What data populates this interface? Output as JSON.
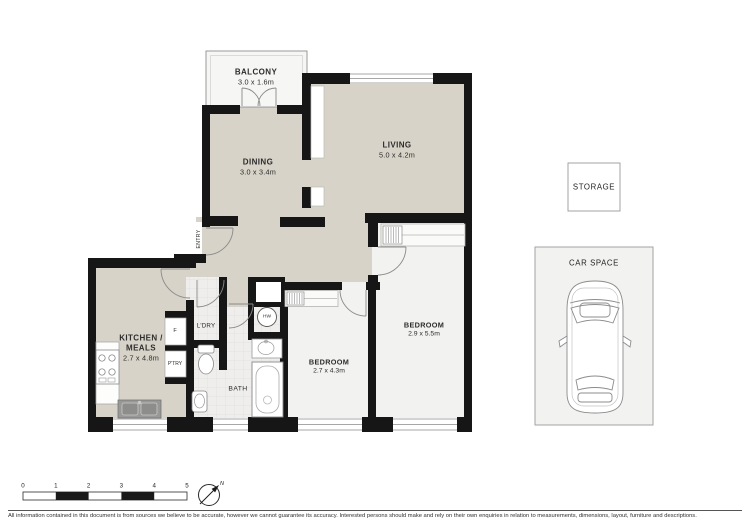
{
  "rooms": {
    "balcony": {
      "label": "BALCONY",
      "dims": "3.0 x 1.6m"
    },
    "dining": {
      "label": "DINING",
      "dims": "3.0 x 3.4m"
    },
    "living": {
      "label": "LIVING",
      "dims": "5.0 x 4.2m"
    },
    "kitchen": {
      "label_line1": "KITCHEN /",
      "label_line2": "MEALS",
      "dims": "2.7 x 4.8m"
    },
    "bedroom1": {
      "label": "BEDROOM",
      "dims": "2.7 x 4.3m"
    },
    "bedroom2": {
      "label": "BEDROOM",
      "dims": "2.9 x 5.5m"
    },
    "bath": {
      "label": "BATH"
    },
    "laundry": {
      "label": "L'DRY"
    },
    "pantry": {
      "label": "P'TRY"
    },
    "fridge": {
      "label": "F"
    },
    "hot_water": {
      "label": "HW"
    },
    "entry": {
      "label": "ENTRY"
    },
    "storage": {
      "label": "STORAGE"
    },
    "car_space": {
      "label": "CAR SPACE"
    }
  },
  "scale_bar": {
    "tick_labels": [
      "0",
      "1",
      "2",
      "3",
      "4",
      "5"
    ]
  },
  "compass": {
    "north": "N"
  },
  "footer": {
    "disclaimer": "All information contained in this document is from sources we believe to be accurate, however we cannot guarantee its accuracy. Interested persons should make and rely on their own enquiries in relation to measurements, dimensions, layout, furniture and descriptions."
  },
  "colors": {
    "wall": "#161616",
    "floor_tan": "#d7d3c8",
    "room_light": "#f2f2f0",
    "tile": "#efeeec",
    "tile_line": "#dedddb",
    "outline_gray": "#8e8e8e"
  }
}
